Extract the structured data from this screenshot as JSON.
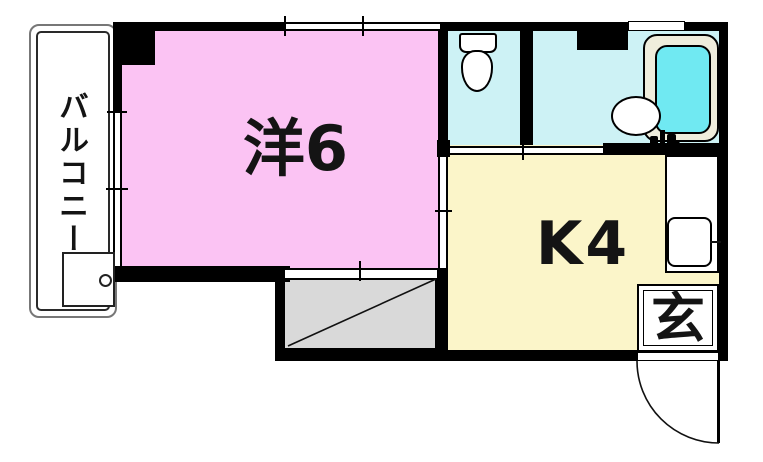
{
  "floor_plan": {
    "rooms": {
      "western": {
        "label": "洋6",
        "fill": "#FBC3F3"
      },
      "kitchen": {
        "label": "K4",
        "fill": "#FBF5C9"
      },
      "balcony": {
        "label": "バルコニー",
        "fill": "#FFFFFF"
      },
      "entrance": {
        "label": "玄",
        "fill": "#FFFFFF"
      },
      "sanitary": {
        "fill": "#CDF2F5"
      },
      "closet": {
        "fill": "#D9D9D9"
      }
    },
    "fixtures": {
      "toilet": {
        "icon": "toilet-icon",
        "fill": "#FFFFFF"
      },
      "bathtub": {
        "icon": "bathtub-icon",
        "rim_fill": "#EFEDDC",
        "water_fill": "#70E9F2"
      },
      "washbasin": {
        "icon": "washbasin-icon",
        "fill": "#FFFFFF"
      },
      "kitchen_sink": {
        "icon": "kitchen-sink-icon",
        "fill": "#FFFFFF"
      },
      "washer_pan": {
        "icon": "washer-pan-icon",
        "fill": "#FFFFFF"
      },
      "entry_door": {
        "icon": "door-swing-icon"
      }
    },
    "wall_color": "#000000"
  }
}
